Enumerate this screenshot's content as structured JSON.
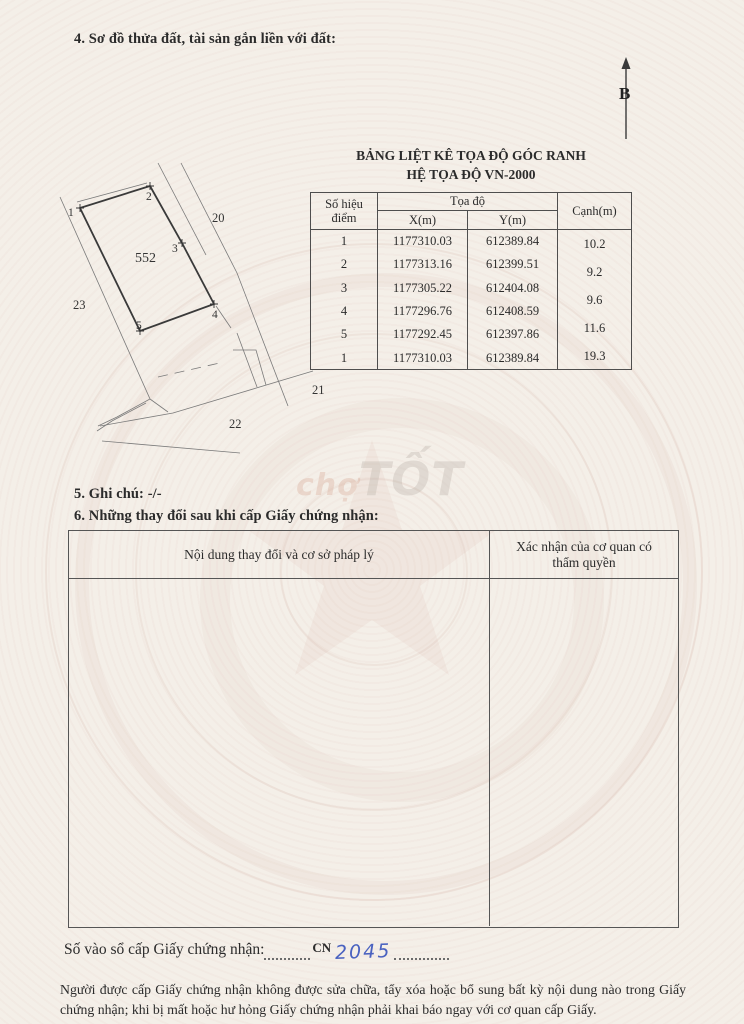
{
  "page": {
    "section4_title": "4. Sơ đồ thửa đất, tài sản gắn liền với đất:",
    "section5_title": "5. Ghi chú: -/-",
    "section6_title": "6. Những thay đổi sau khi cấp Giấy chứng nhận:",
    "registry_label": "Số vào sổ cấp Giấy chứng nhận:",
    "registry_prefix": "CN",
    "registry_number": "2045",
    "footer_text": "Người được cấp Giấy chứng nhận không được sửa chữa, tẩy xóa hoặc bổ sung bất kỳ nội dung nào trong Giấy chứng nhận; khi bị mất hoặc hư hỏng Giấy chứng nhận phải khai báo ngay với cơ quan cấp Giấy.",
    "watermark_prefix": "chợ",
    "watermark_main": "TỐT",
    "north_label": "B"
  },
  "coord_table": {
    "title_line1": "BẢNG LIỆT KÊ TỌA ĐỘ GÓC RANH",
    "title_line2": "HỆ TỌA ĐỘ VN-2000",
    "col_point": "Số hiệu điểm",
    "col_group": "Tọa độ",
    "col_x": "X(m)",
    "col_y": "Y(m)",
    "col_edge": "Cạnh(m)",
    "rows": [
      {
        "p": "1",
        "x": "1177310.03",
        "y": "612389.84"
      },
      {
        "p": "2",
        "x": "1177313.16",
        "y": "612399.51"
      },
      {
        "p": "3",
        "x": "1177305.22",
        "y": "612404.08"
      },
      {
        "p": "4",
        "x": "1177296.76",
        "y": "612408.59"
      },
      {
        "p": "5",
        "x": "1177292.45",
        "y": "612397.86"
      },
      {
        "p": "1",
        "x": "1177310.03",
        "y": "612389.84"
      }
    ],
    "edges": [
      "10.2",
      "9.2",
      "9.6",
      "11.6",
      "19.3"
    ]
  },
  "changes_table": {
    "col_left": "Nội dung thay đổi và cơ sở pháp lý",
    "col_right": "Xác nhận của cơ quan có thẩm quyền"
  },
  "diagram": {
    "parcel_number": "552",
    "v1": "1",
    "v2": "2",
    "v3": "3",
    "v4": "4",
    "v5": "5",
    "n20": "20",
    "n21": "21",
    "n22": "22",
    "n23": "23"
  }
}
